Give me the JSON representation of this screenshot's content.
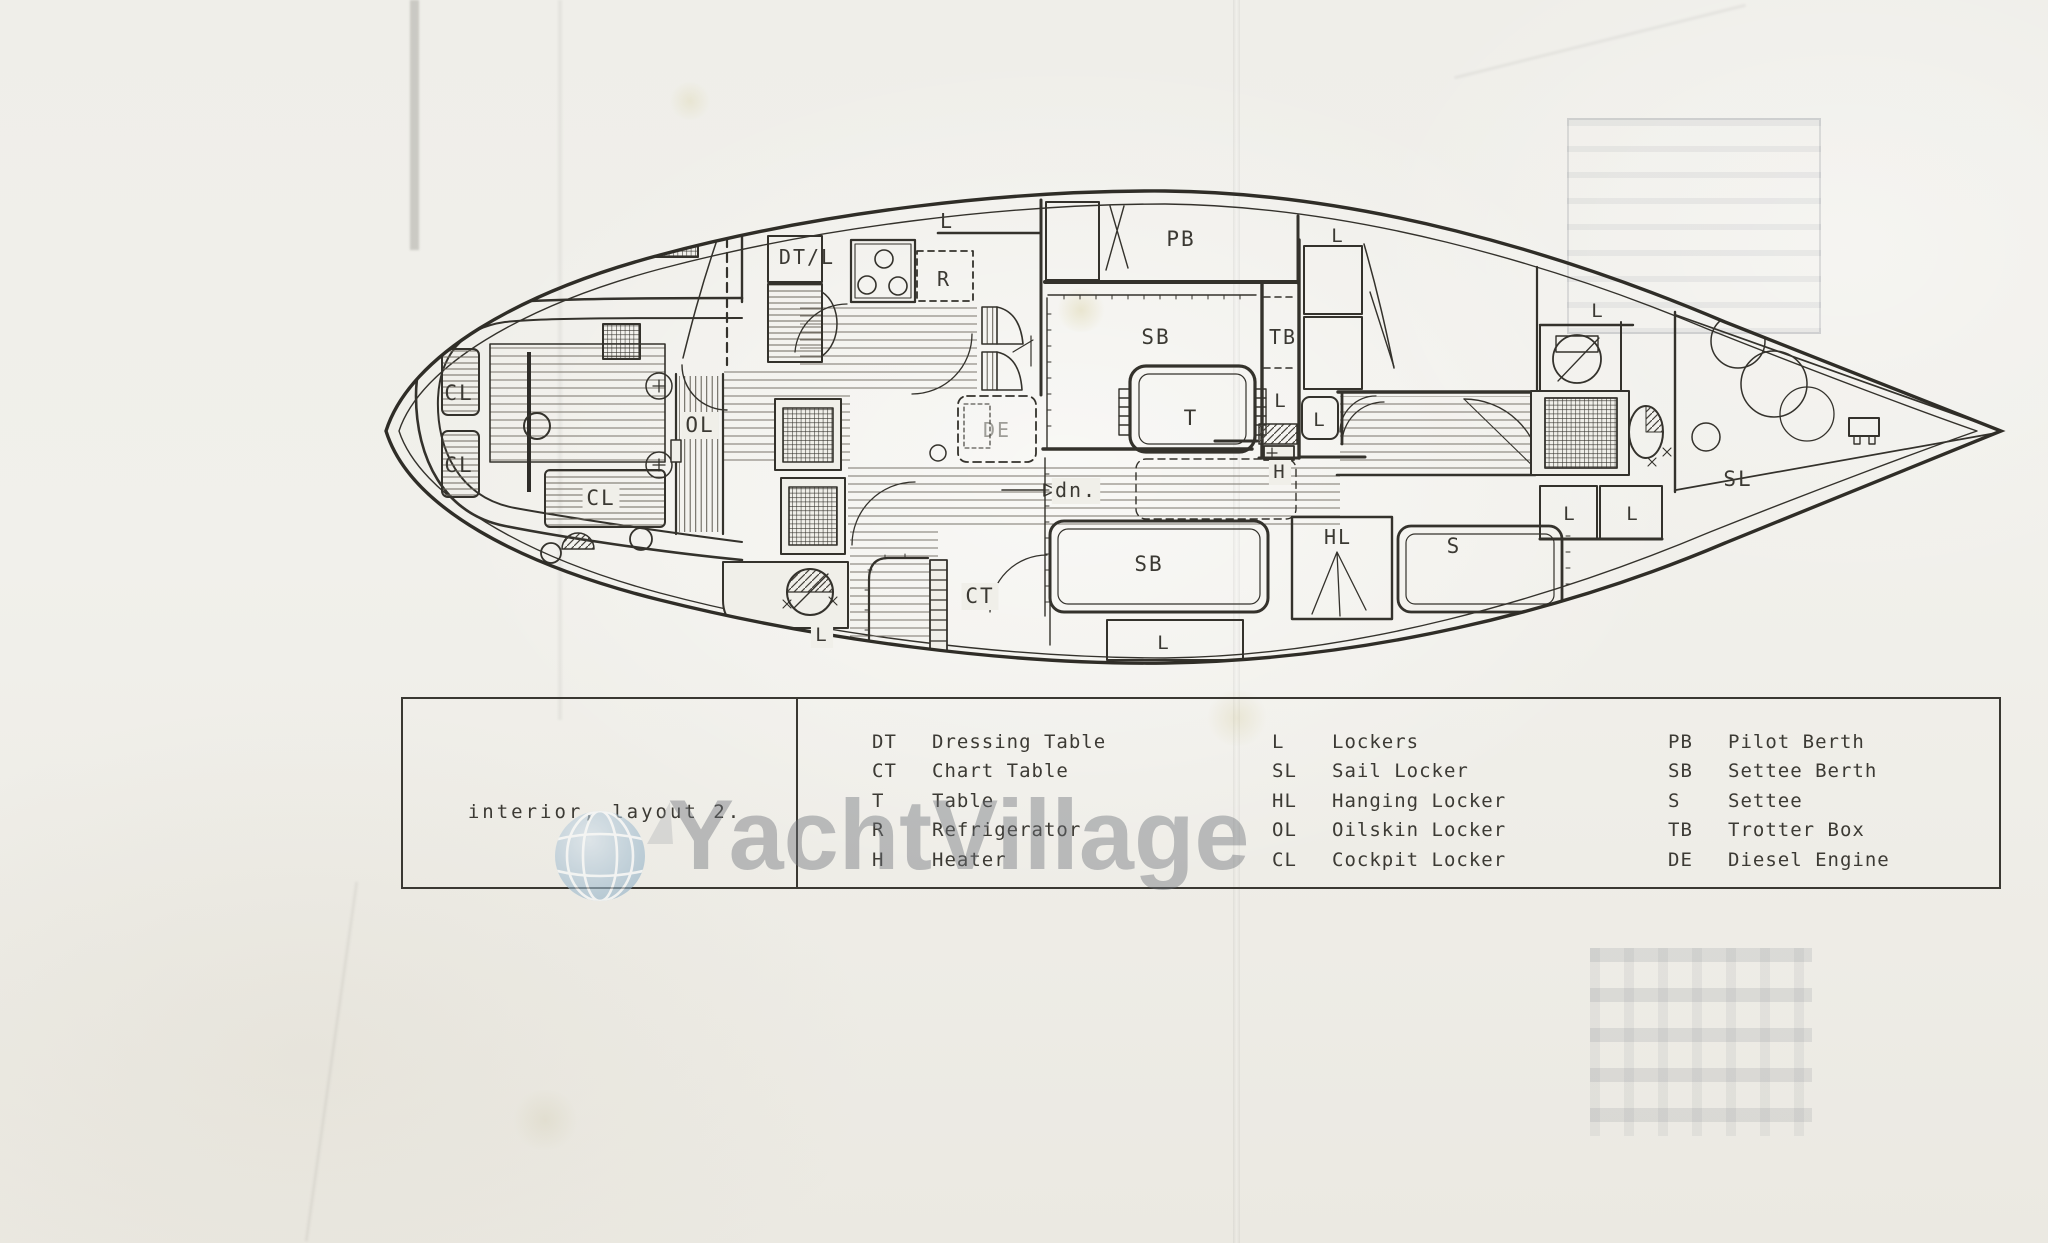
{
  "document": {
    "title": "interior, layout 2.",
    "watermark": "YachtVillage"
  },
  "colors": {
    "ink": "#34322c",
    "paper": "#f0efe9",
    "watermark_gray": "rgba(108,112,118,0.42)",
    "globe_blue": "#a9c2d4"
  },
  "legend": {
    "columns": [
      {
        "items": [
          {
            "abbr": "DT",
            "label": "Dressing Table"
          },
          {
            "abbr": "CT",
            "label": "Chart Table"
          },
          {
            "abbr": "T",
            "label": "Table"
          },
          {
            "abbr": "R",
            "label": "Refrigerator"
          },
          {
            "abbr": "H",
            "label": "Heater"
          }
        ]
      },
      {
        "items": [
          {
            "abbr": "L",
            "label": "Lockers"
          },
          {
            "abbr": "SL",
            "label": "Sail Locker"
          },
          {
            "abbr": "HL",
            "label": "Hanging Locker"
          },
          {
            "abbr": "OL",
            "label": "Oilskin Locker"
          },
          {
            "abbr": "CL",
            "label": "Cockpit Locker"
          }
        ]
      },
      {
        "items": [
          {
            "abbr": "PB",
            "label": "Pilot Berth"
          },
          {
            "abbr": "SB",
            "label": "Settee Berth"
          },
          {
            "abbr": "S",
            "label": "Settee"
          },
          {
            "abbr": "TB",
            "label": "Trotter Box"
          },
          {
            "abbr": "DE",
            "label": "Diesel Engine"
          }
        ]
      }
    ]
  },
  "plan_labels": [
    {
      "t": "CL",
      "x": 459,
      "y": 400,
      "s": 21,
      "bg": 0,
      "dim": 0
    },
    {
      "t": "CL",
      "x": 459,
      "y": 472,
      "s": 21,
      "bg": 0,
      "dim": 0
    },
    {
      "t": "CL",
      "x": 601,
      "y": 505,
      "s": 21,
      "bg": 1,
      "dim": 0
    },
    {
      "t": "OL",
      "x": 700,
      "y": 432,
      "s": 21,
      "bg": 1,
      "dim": 0
    },
    {
      "t": "DT/L",
      "x": 807,
      "y": 264,
      "s": 20,
      "bg": 0,
      "dim": 0
    },
    {
      "t": "L",
      "x": 947,
      "y": 228,
      "s": 20,
      "bg": 0,
      "dim": 0
    },
    {
      "t": "R",
      "x": 944,
      "y": 286,
      "s": 20,
      "bg": 0,
      "dim": 0
    },
    {
      "t": "PB",
      "x": 1181,
      "y": 246,
      "s": 21,
      "bg": 0,
      "dim": 0
    },
    {
      "t": "L",
      "x": 1338,
      "y": 242,
      "s": 19,
      "bg": 0,
      "dim": 0
    },
    {
      "t": "SB",
      "x": 1156,
      "y": 344,
      "s": 21,
      "bg": 0,
      "dim": 0
    },
    {
      "t": "TB",
      "x": 1283,
      "y": 344,
      "s": 20,
      "bg": 0,
      "dim": 0
    },
    {
      "t": "L",
      "x": 1281,
      "y": 407,
      "s": 19,
      "bg": 0,
      "dim": 0
    },
    {
      "t": "T",
      "x": 1191,
      "y": 425,
      "s": 21,
      "bg": 0,
      "dim": 0
    },
    {
      "t": "L",
      "x": 1320,
      "y": 426,
      "s": 19,
      "bg": 0,
      "dim": 0
    },
    {
      "t": "H",
      "x": 1280,
      "y": 478,
      "s": 19,
      "bg": 1,
      "dim": 0
    },
    {
      "t": "DE",
      "x": 997,
      "y": 437,
      "s": 20,
      "bg": 0,
      "dim": 1
    },
    {
      "t": "dn.",
      "x": 1076,
      "y": 497,
      "s": 20,
      "bg": 1,
      "dim": 0
    },
    {
      "t": "SB",
      "x": 1149,
      "y": 571,
      "s": 21,
      "bg": 0,
      "dim": 0
    },
    {
      "t": "L",
      "x": 1164,
      "y": 649,
      "s": 19,
      "bg": 0,
      "dim": 0
    },
    {
      "t": "CT",
      "x": 980,
      "y": 603,
      "s": 21,
      "bg": 1,
      "dim": 0
    },
    {
      "t": "L",
      "x": 822,
      "y": 641,
      "s": 19,
      "bg": 1,
      "dim": 0
    },
    {
      "t": "HL",
      "x": 1338,
      "y": 544,
      "s": 20,
      "bg": 0,
      "dim": 0
    },
    {
      "t": "S",
      "x": 1454,
      "y": 553,
      "s": 21,
      "bg": 0,
      "dim": 0
    },
    {
      "t": "L",
      "x": 1598,
      "y": 317,
      "s": 19,
      "bg": 0,
      "dim": 0
    },
    {
      "t": "L",
      "x": 1570,
      "y": 520,
      "s": 19,
      "bg": 0,
      "dim": 0
    },
    {
      "t": "L",
      "x": 1633,
      "y": 520,
      "s": 19,
      "bg": 0,
      "dim": 0
    },
    {
      "t": "SL",
      "x": 1738,
      "y": 486,
      "s": 21,
      "bg": 0,
      "dim": 0
    }
  ]
}
